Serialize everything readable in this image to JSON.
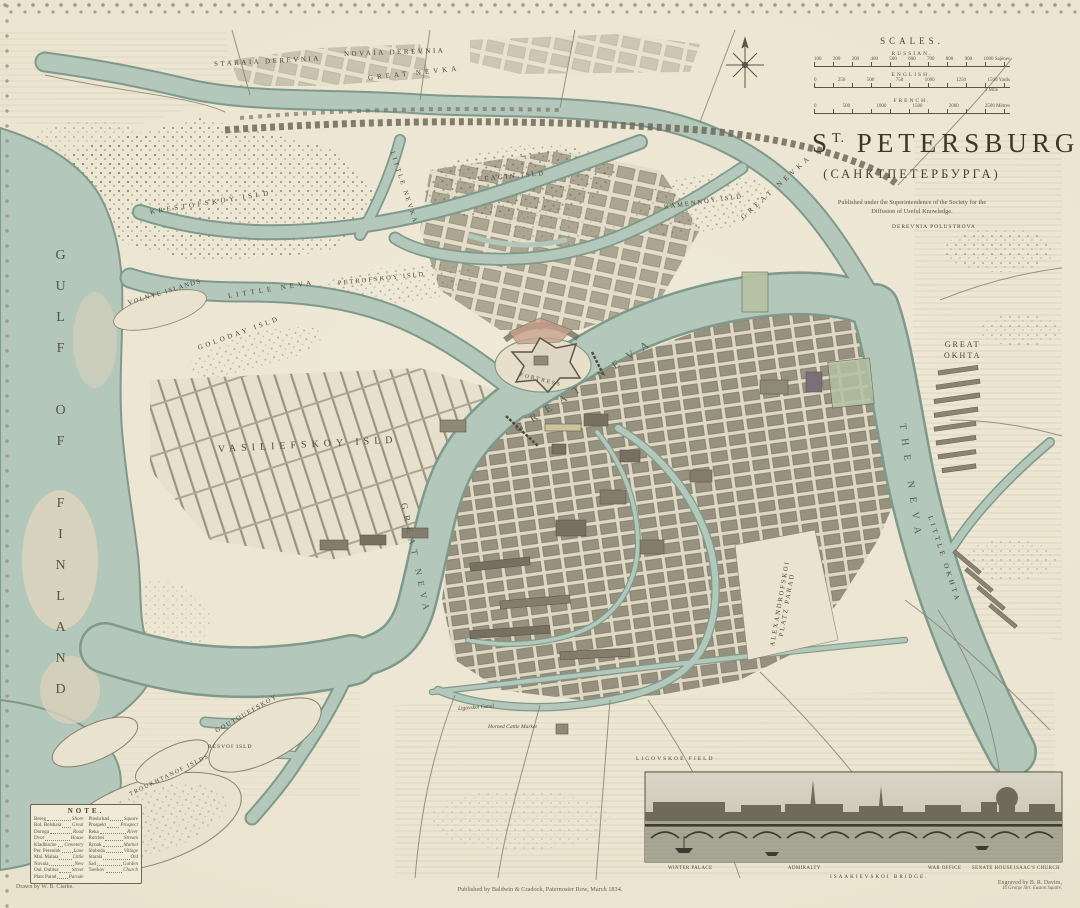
{
  "title_block": {
    "scales_heading": "SCALES.",
    "scales": [
      {
        "name": "RUSSIAN.",
        "ticks": [
          "100",
          "200",
          "300",
          "400",
          "500",
          "600",
          "700",
          "800",
          "900",
          "1000 Sajènes"
        ]
      },
      {
        "name": "ENGLISH.",
        "ticks": [
          "0",
          "250",
          "500",
          "750",
          "1000",
          "1250",
          "1500 Yards"
        ],
        "sub": "1 Mile"
      },
      {
        "name": "FRENCH.",
        "ticks": [
          "0",
          "500",
          "1000",
          "1500",
          "2000",
          "2500 Mètres"
        ]
      }
    ],
    "title_s": "S",
    "title_sup": "T.",
    "title_rest": "PETERSBURG,",
    "subtitle": "(САНКТПЕТЕРБУРГА)",
    "published_1": "Published under the Superintendence of the Society for the",
    "published_2": "Diffusion of Useful Knowledge."
  },
  "map_labels": {
    "gulf": "GULF OF FINLAND",
    "staraia_derevnia": "STARAIA DEREVNIA",
    "novaia_derevnia": "NOVAIA DEREVNIA",
    "great_nevka_w": "GREAT NEVKA",
    "great_nevka_e": "GREAT NEVKA",
    "little_nevka": "LITTLE NEVKA",
    "little_neva": "LITTLE NEVA",
    "elagin": "ELAGIN ISLD",
    "kamennoy": "KAMENNOY ISLD",
    "krestofskoy": "KRESTOFSKOY ISLD",
    "petrofskoy": "PETROFSKOY ISLD",
    "volnye": "VOLNYE ISLANDS",
    "goloday": "GOLODAY ISLD",
    "vasiliefskoy": "VASILIEFSKOY ISLD",
    "great_neva_main": "GREAT NEVA",
    "great_neva_south": "GREAT NEVA",
    "the_neva": "THE NEVA",
    "great_okhta_1": "GREAT",
    "great_okhta_2": "OKHTA",
    "little_okhta": "LITTLE OKHTA",
    "polustrova": "DEREVNIA POLUSTROVA",
    "fortress": "FORTRESS",
    "alexandrofskoi_1": "ALEXANDROFSKOI",
    "alexandrofskoi_2": "PLATZ PARAD",
    "cattle_market": "Horned Cattle Market",
    "ligovskoi_canal": "Ligovskoi Canal",
    "ligovskoe_field": "LIGOVSKOE FIELD",
    "goutouefskoy": "GOUTOUEFSKOY",
    "resvoi": "RÉSVOI ISLD",
    "troukhtanof": "TROUKHTANOF ISLDS"
  },
  "note": {
    "heading": "NOTE.",
    "left": [
      {
        "ru": "Bereg",
        "en": "Shore"
      },
      {
        "ru": "Bol. Bolshaia",
        "en": "Great"
      },
      {
        "ru": "Doroga",
        "en": "Road"
      },
      {
        "ru": "Dvor",
        "en": "House"
      },
      {
        "ru": "Kladbische",
        "en": "Cemetery"
      },
      {
        "ru": "Per. Pereulok",
        "en": "Lane"
      },
      {
        "ru": "Mal. Malaia",
        "en": "Little"
      },
      {
        "ru": "Novaia",
        "en": "New"
      },
      {
        "ru": "Oul. Oulitsa",
        "en": "Street"
      },
      {
        "ru": "Plats Parad",
        "en": "Parade"
      }
    ],
    "right": [
      {
        "ru": "Ploshchad",
        "en": "Square"
      },
      {
        "ru": "Prospekt",
        "en": "Prospect"
      },
      {
        "ru": "Reka",
        "en": "River"
      },
      {
        "ru": "Rutchei",
        "en": "Stream"
      },
      {
        "ru": "Rynok",
        "en": "Market"
      },
      {
        "ru": "Sloboda",
        "en": "Village"
      },
      {
        "ru": "Staraia",
        "en": "Old"
      },
      {
        "ru": "Sad",
        "en": "Garden"
      },
      {
        "ru": "Tserkov",
        "en": "Church"
      }
    ]
  },
  "panorama": {
    "captions": [
      "WINTER PALACE",
      "ADMIRALTY",
      "WAR OFFICE",
      "SENATE HOUSE",
      "ISAAC'S CHURCH"
    ],
    "bridge_caption": "ISAAKIEVSKOI BRIDGE."
  },
  "credits": {
    "drawn": "Drawn by W. B. Clarke.",
    "engraved_1": "Engraved by B. R. Davies,",
    "engraved_2": "16 George Strt. Euston Square.",
    "imprint": "Published by Baldwin & Cradock, Paternoster Row, March 1834."
  },
  "colors": {
    "paper": "#ece5d1",
    "water": "#b3c7ba",
    "water_edge": "#7d9a8b",
    "ink": "#4a4336",
    "blocks": "#8f8977",
    "woods": "#5e6352",
    "garden_green": "#b6c2a2",
    "citadel_red": "#c9a28f"
  }
}
